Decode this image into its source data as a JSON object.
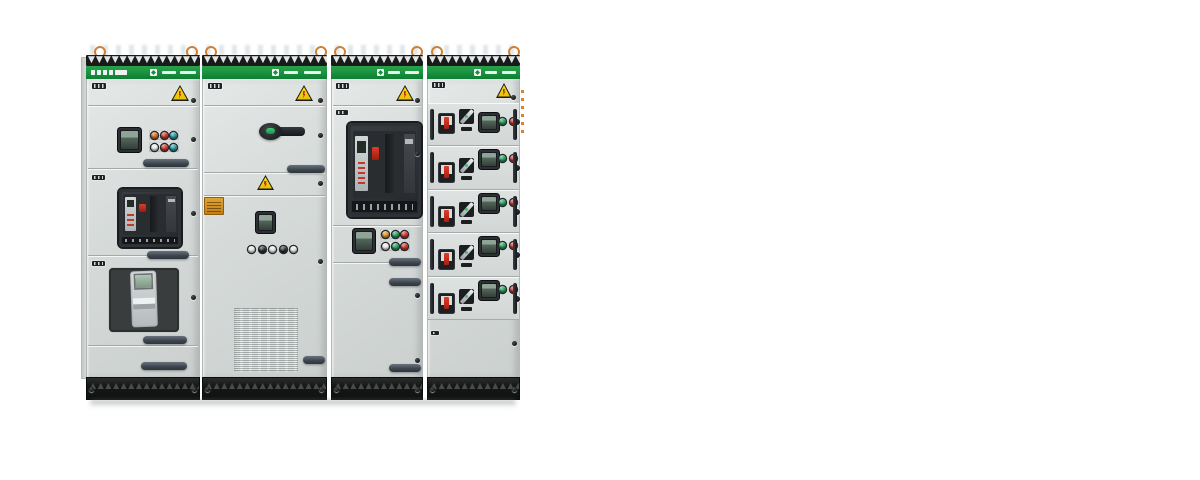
{
  "scene": {
    "kind": "product-photograph",
    "subject": "low-voltage switchgear cabinet lineup, four panels on white background",
    "background_color": "#ffffff",
    "panel_count": 4
  },
  "colors": {
    "brand_green": "#1e9b43",
    "band_shadow_green": "#0d7a31",
    "cabinet_gray": "#d7dbda",
    "cabinet_gray_dark": "#c9cecd",
    "seam_gray": "#a6acab",
    "plinth_black": "#141616",
    "channel_black": "#191b1b",
    "warning_yellow": "#f2d20c",
    "warning_red": "#c4231b",
    "device_dark": "#1d2023",
    "display_green": "#8fa496",
    "handle_gray": "#49505a",
    "copper_eyebolt": "#cd8138",
    "sticker_orange": "#d89a2b",
    "accent_red": "#cf3327",
    "accent_green": "#1fa05a",
    "accent_orange": "#d96b1e",
    "accent_teal": "#2a9d9f"
  },
  "icons": {
    "warning": "hazard-warning-triangle-icon",
    "eyebolt": "lifting-eye-bolt-icon",
    "brand_logo": "manufacturer-logo-block",
    "brand_wordmark": "manufacturer-wordmark"
  },
  "panels": {
    "incomer_a": {
      "data_name": "panel-1",
      "features": [
        "nameplate-strip",
        "warning-label",
        "meter-display",
        "pushbutton-cluster",
        "air-circuit-breaker",
        "meter-window",
        "door-handles"
      ],
      "button_rows": [
        [
          "#d96b1e",
          "#cf3327",
          "#2a9d9f"
        ],
        [
          "#ececec",
          "#cf3327",
          "#2a9d9f"
        ]
      ]
    },
    "main_switch": {
      "data_name": "panel-2",
      "features": [
        "warning-label",
        "rotary-main-handle",
        "warning-label-small",
        "orange-sticker",
        "meter-display",
        "indicator-row",
        "ventilation-grille",
        "door-handles"
      ],
      "indicator_row": [
        "#e3e7e8",
        "#2a2d31",
        "#e3e7e8",
        "#2a2d31",
        "#e3e7e8"
      ]
    },
    "incomer_b": {
      "data_name": "panel-3",
      "features": [
        "warning-label",
        "air-circuit-breaker",
        "meter-display",
        "pushbutton-cluster",
        "door-handles"
      ],
      "button_rows": [
        [
          "#e2931d",
          "#1fa05a",
          "#cf3327"
        ],
        [
          "#ececec",
          "#1fa05a",
          "#cf3327"
        ]
      ]
    },
    "feeder": {
      "data_name": "panel-4",
      "features": [
        "warning-label",
        "withdrawable-drawers",
        "blank-door"
      ],
      "drawer_count": 5,
      "drawers": [
        {
          "variant": "a",
          "buttons": [
            "#1fa05a",
            "#cf3327"
          ]
        },
        {
          "variant": "b",
          "buttons": [
            "#1fa05a",
            "#cf3327"
          ]
        },
        {
          "variant": "b",
          "buttons": [
            "#1fa05a",
            "#cf3327"
          ]
        },
        {
          "variant": "b",
          "buttons": [
            "#1fa05a",
            "#cf3327"
          ]
        },
        {
          "variant": "b",
          "buttons": [
            "#1fa05a",
            "#cf3327"
          ]
        }
      ]
    }
  }
}
